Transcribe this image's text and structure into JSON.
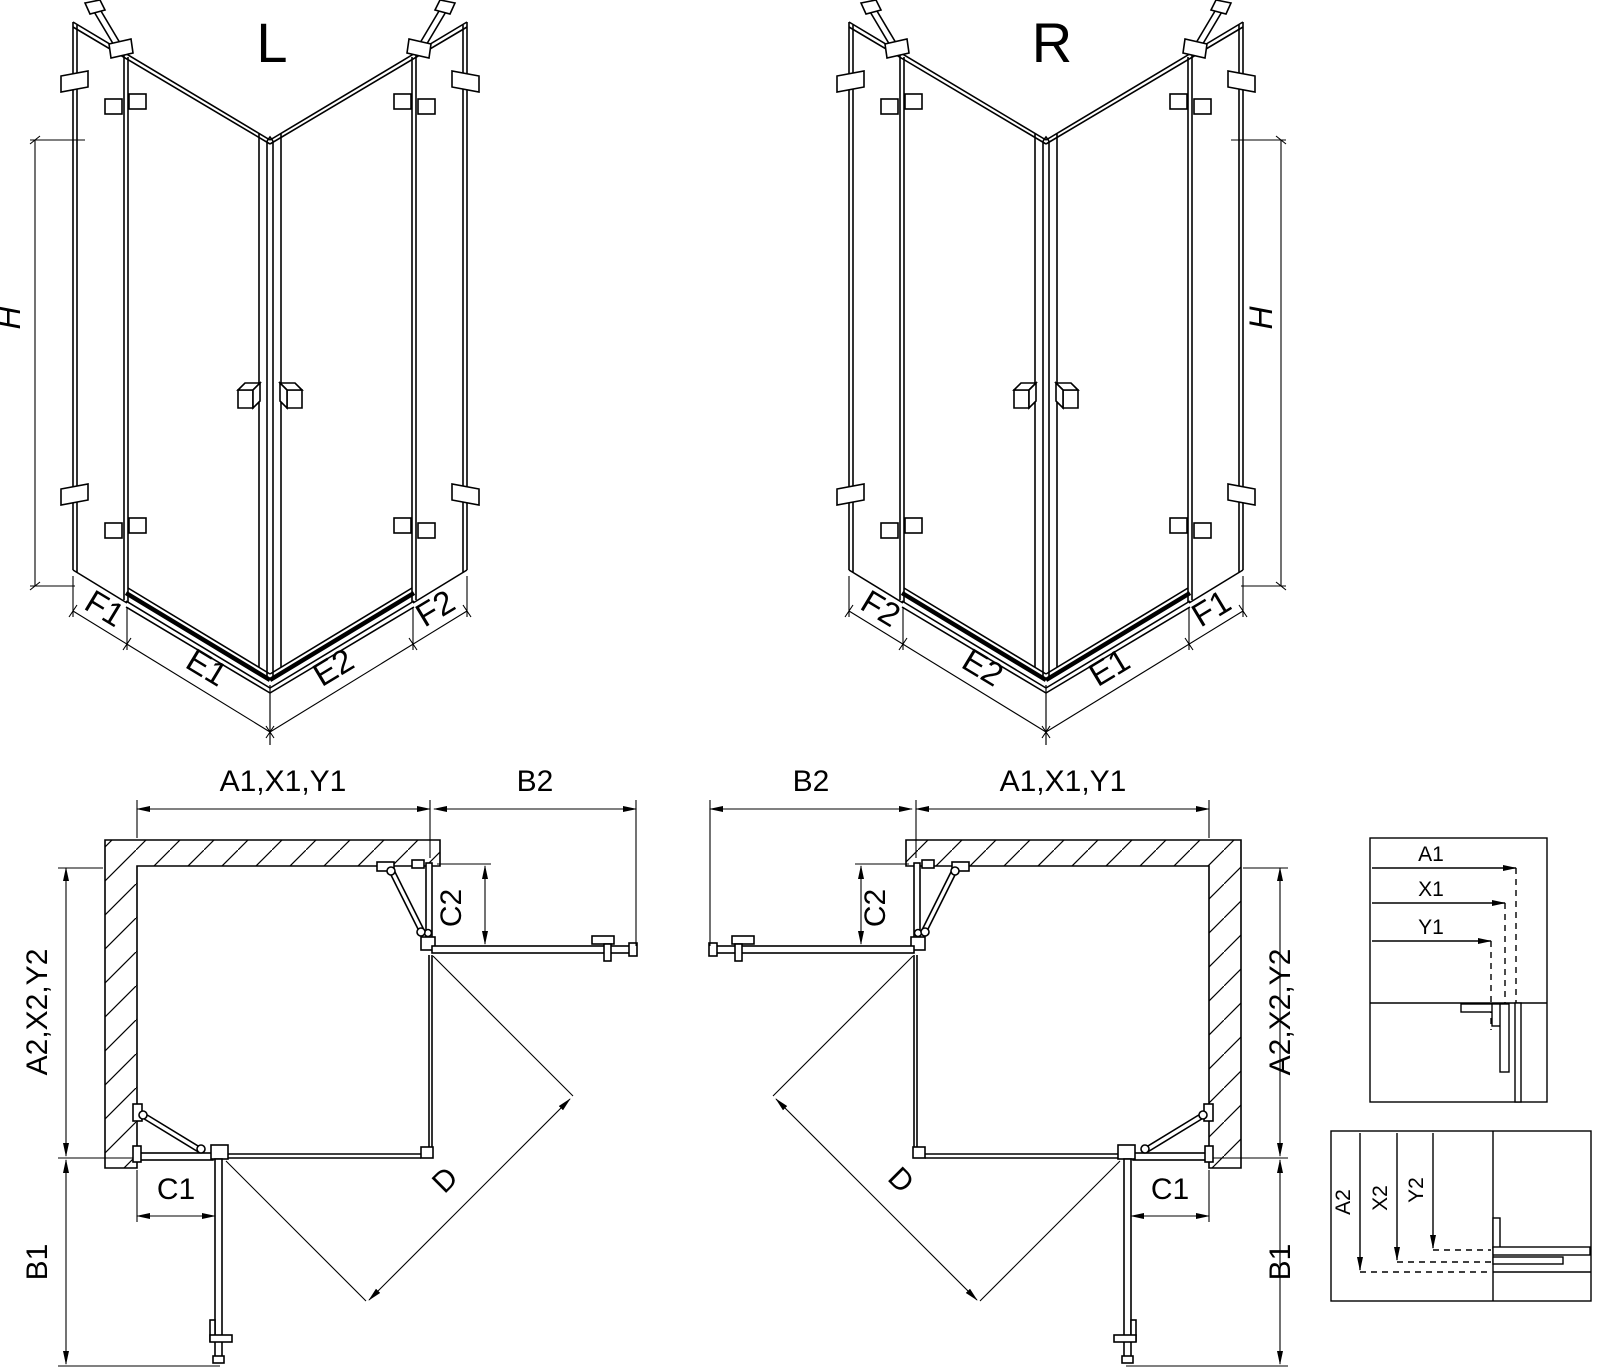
{
  "drawing": {
    "variant_left": {
      "title": "L",
      "height_label": "H",
      "labels": {
        "fixed_left": "F1",
        "door_left": "E1",
        "door_right": "E2",
        "fixed_right": "F2"
      }
    },
    "variant_right": {
      "title": "R",
      "height_label": "H",
      "labels": {
        "fixed_left": "F2",
        "door_left": "E2",
        "door_right": "E1",
        "fixed_right": "F1"
      }
    },
    "plan_left": {
      "width_total": "A1,X1,Y1",
      "door_open_width": "B2",
      "fixed_panel_side": "C2",
      "depth_total": "A2,X2,Y2",
      "fixed_panel_front": "C1",
      "door_open_depth": "B1",
      "diagonal_entry": "D"
    },
    "plan_right": {
      "width_total": "A1,X1,Y1",
      "door_open_width": "B2",
      "fixed_panel_side": "C2",
      "depth_total": "A2,X2,Y2",
      "fixed_panel_front": "C1",
      "door_open_depth": "B1",
      "diagonal_entry": "D"
    },
    "detail_width": {
      "labels": [
        "A1",
        "X1",
        "Y1"
      ]
    },
    "detail_depth": {
      "labels": [
        "A2",
        "X2",
        "Y2"
      ]
    },
    "colors": {
      "line": "#000000",
      "background": "#ffffff"
    }
  }
}
